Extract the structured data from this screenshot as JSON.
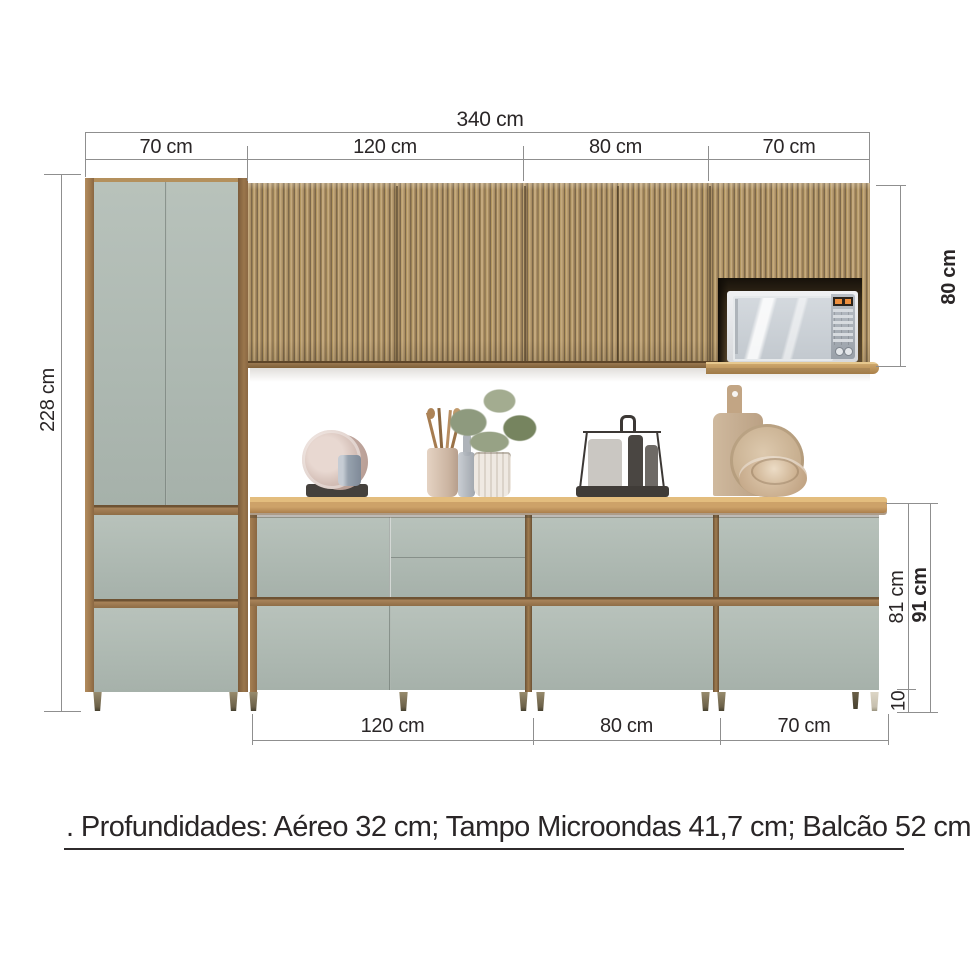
{
  "diagram": {
    "overall_width": "340 cm",
    "top_segments": [
      "70 cm",
      "120 cm",
      "80 cm",
      "70 cm"
    ],
    "left_height": "228 cm",
    "upper_cabinet_height": "80 cm",
    "base_total_height": "91 cm",
    "base_body_height": "81 cm",
    "base_leg_height": "10",
    "bottom_segments": [
      "120 cm",
      "80 cm",
      "70 cm"
    ],
    "footer_note": ". Profundidades: Aéreo 32 cm; Tampo Microondas 41,7 cm; Balcão 52 cm"
  },
  "colors": {
    "dimension_line": "#8f8f8f",
    "dimension_text": "#2a2627",
    "wood": "#b08a5c",
    "wood_dark": "#7d684b",
    "countertop": "#cda269",
    "cabinet_panel_green": "#afb9b2",
    "microwave_display_orange": "#ed8f3e",
    "leg_olive": "#877b5e",
    "leg_cream": "#d9d2c2"
  }
}
